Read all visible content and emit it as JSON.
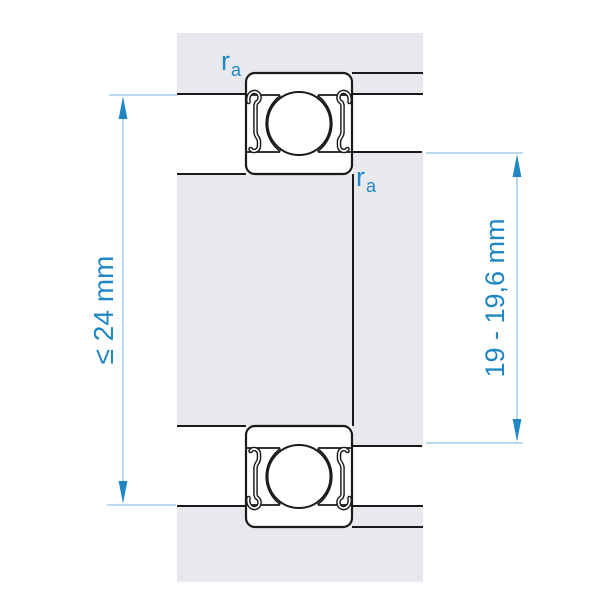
{
  "labels": {
    "dim_left": "≤ 24 mm",
    "dim_right": "19 - 19,6 mm",
    "fillet_base": "r",
    "fillet_sub": "a"
  },
  "colors": {
    "accent_blue": "#1f87c4",
    "dim_line_blue": "#8fc3e2",
    "material_gray": "#e8e9ed",
    "contour_black": "#1a1a1a",
    "background": "#ffffff"
  }
}
